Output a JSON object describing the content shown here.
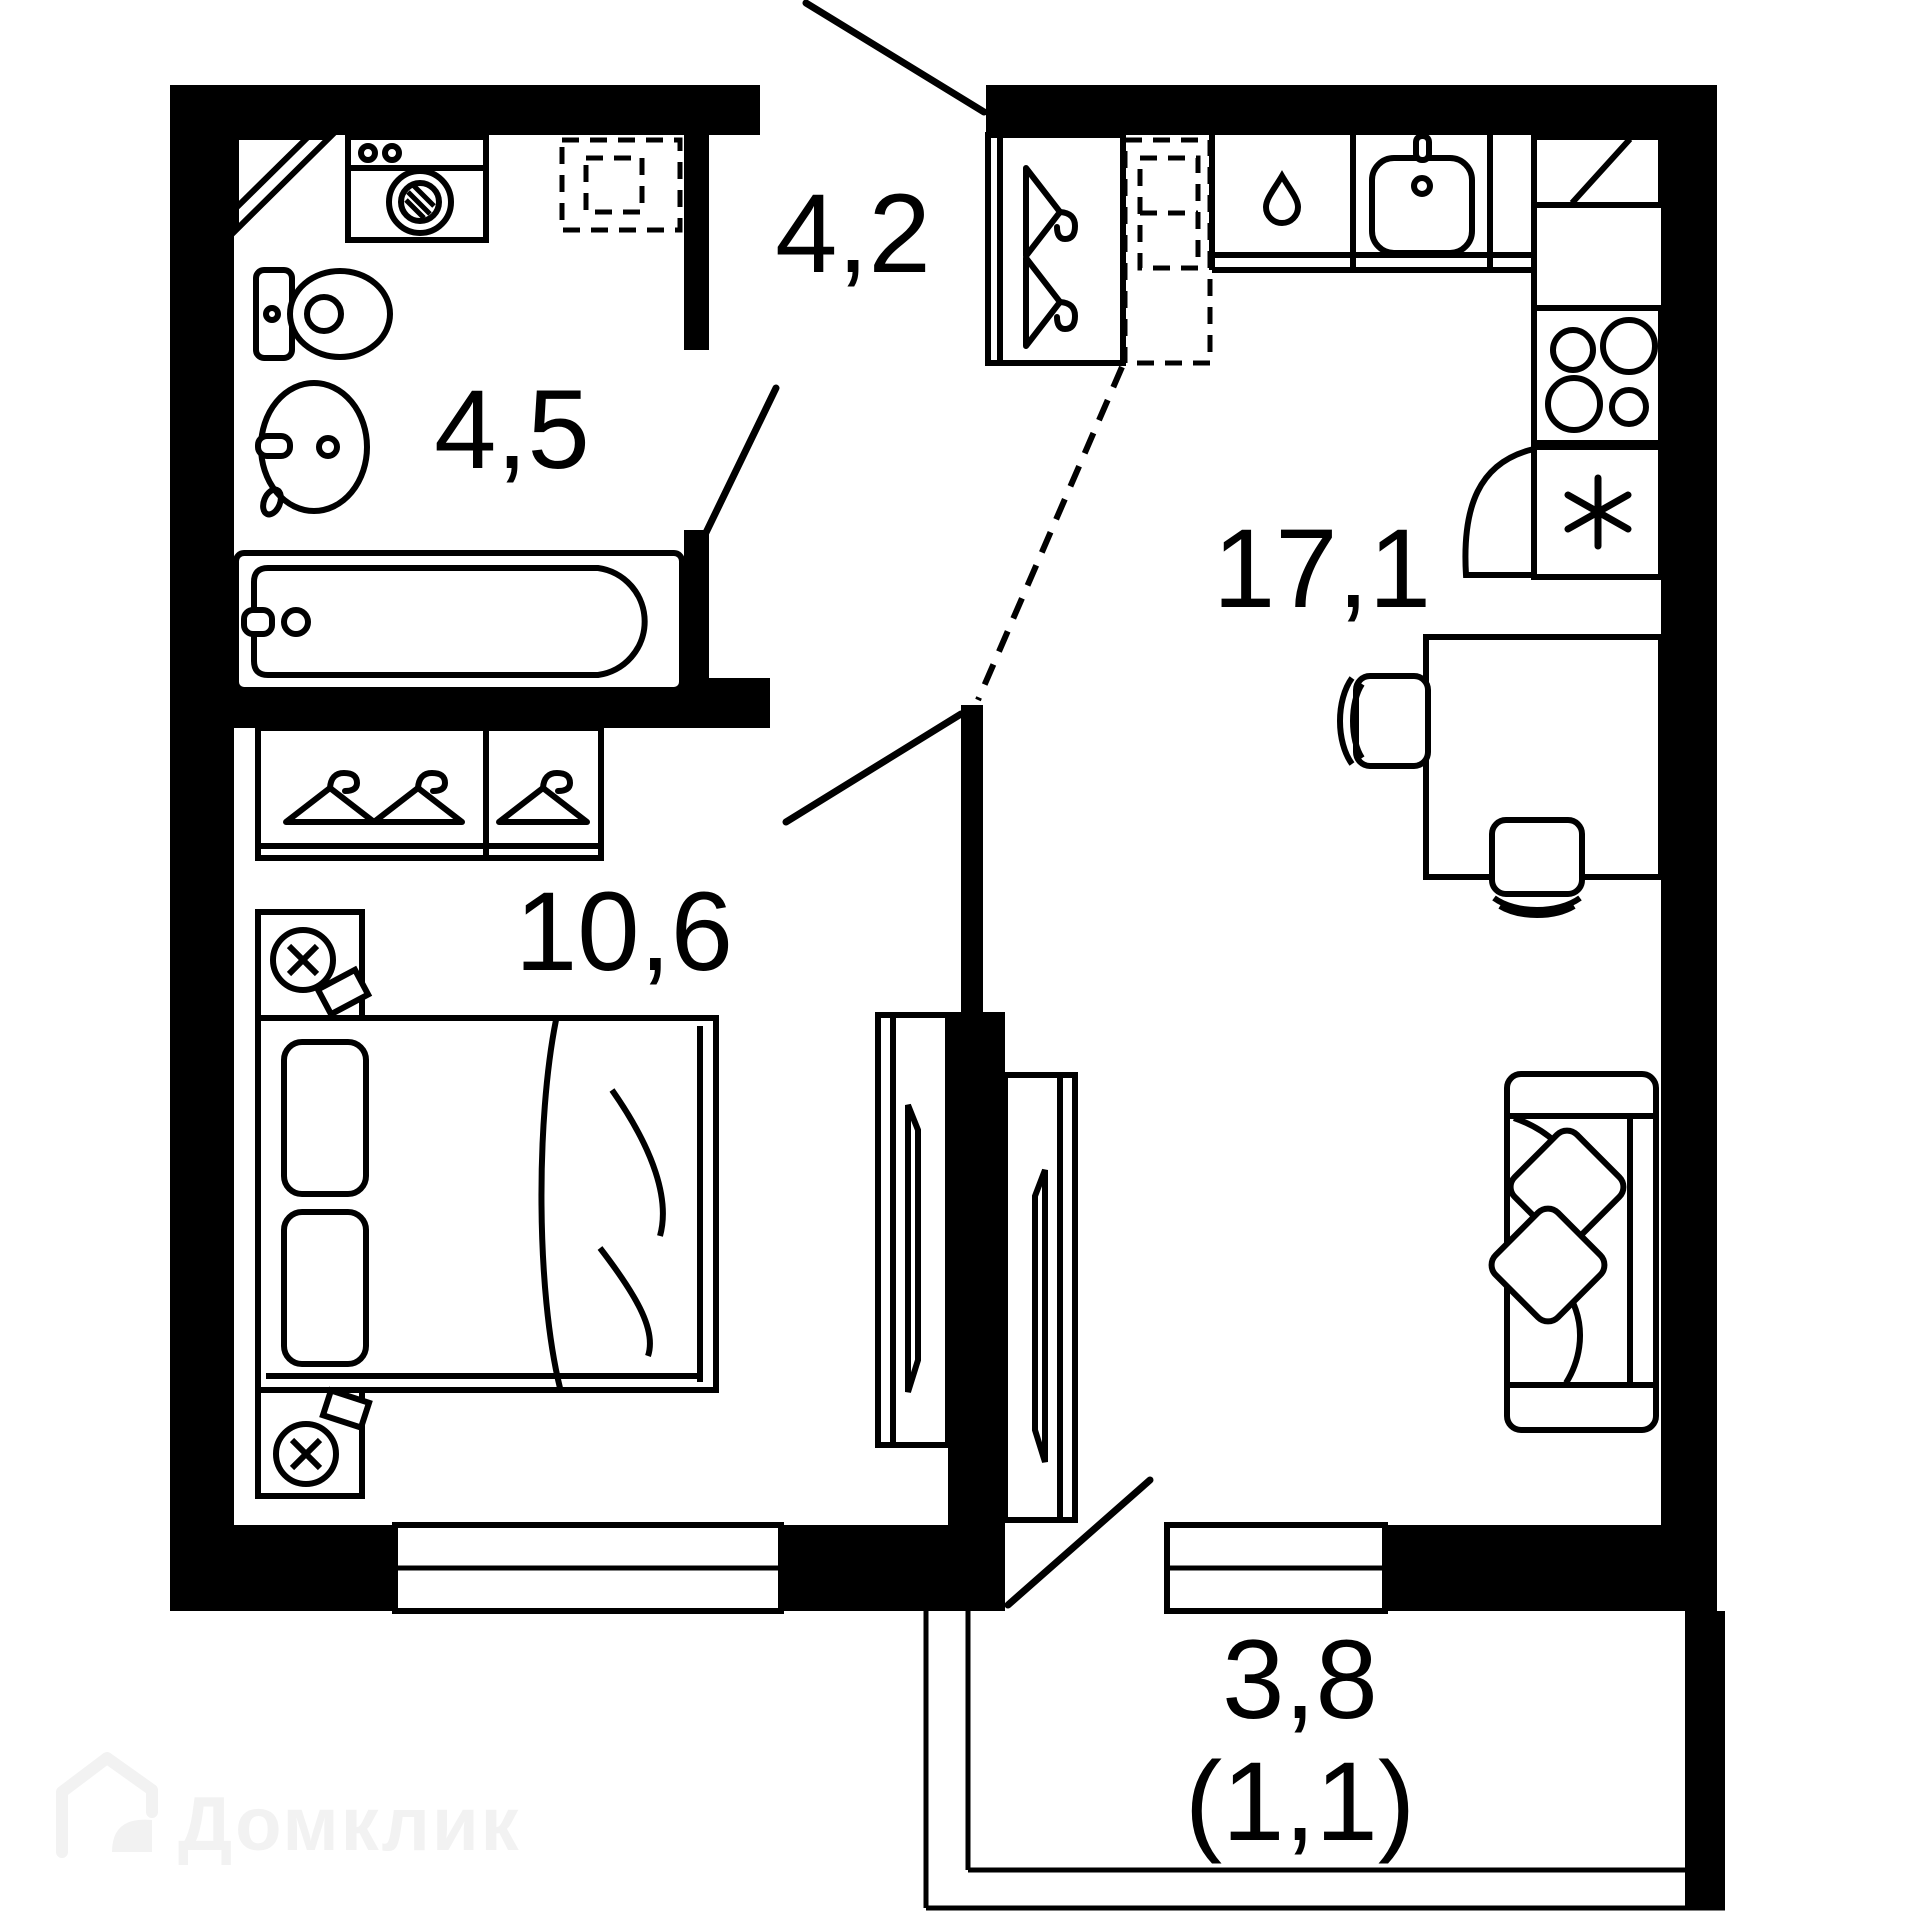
{
  "plan": {
    "type": "apartment-floor-plan",
    "colors": {
      "background": "#ffffff",
      "walls": "#000000",
      "fixtures": "#000000",
      "watermark": "#f2f2f2"
    },
    "rooms": {
      "bathroom": {
        "label": "4,5"
      },
      "hallway": {
        "label": "4,2"
      },
      "kitchen_living": {
        "label": "17,1"
      },
      "bedroom": {
        "label": "10,6"
      },
      "balcony": {
        "label": "3,8",
        "secondary_label": "(1,1)"
      }
    },
    "fixtures": [
      "washing-machine",
      "corner-shelf",
      "water-heater-dashed",
      "toilet",
      "wash-basin",
      "bathtub",
      "wardrobe-hangers",
      "nightstand-lamp",
      "double-bed",
      "sliding-wardrobe",
      "hallway-closet-hangers",
      "fridge-dashed",
      "kitchen-cabinet-drop",
      "kitchen-sink",
      "corner-cabinet",
      "stove-4-burners",
      "freezer-asterisk",
      "dining-table",
      "chair",
      "sofa-with-pillows",
      "balcony-railing",
      "window",
      "door-swing"
    ]
  },
  "watermark": {
    "text": "Домклик"
  }
}
